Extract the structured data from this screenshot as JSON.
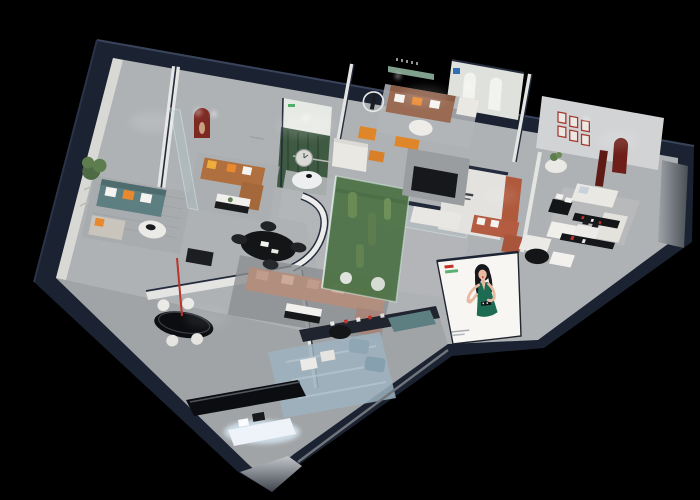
{
  "scene": {
    "kind": "3d-isometric-showroom-floorplan-render",
    "background": "#000000",
    "palette": {
      "outer_wall": "#1B2231",
      "outer_wall_edge": "#39445C",
      "floor": "#AFB2B5",
      "wall_white": "#E8E8E6",
      "mural_forest": "#3F5A42",
      "mural_sky": "#E7EAE4",
      "niche_red": "#7D2B22",
      "frame_red": "#A63A2E",
      "arch_dark_red": "#6E1F19",
      "column_dark_red": "#5E1B15",
      "terracotta_cabinet": "#B05A3D",
      "sofa_teal": "#5E7F82",
      "sofa_caramel": "#B06F3E",
      "sofa_brown": "#9A6A52",
      "sofa_white": "#EAE8E3",
      "sofa_mauve": "#B28E7F",
      "sofa_terracotta": "#B35C41",
      "pillow_orange": "#E8892F",
      "pillow_yellow": "#EFAE3B",
      "shelf_green": "#7FA08C",
      "sign_blue": "#2E6FB7",
      "logo_green": "#3FA65C",
      "logo_red": "#C23326",
      "garden_green": "#4F7348",
      "cactus_green": "#6B8B55",
      "orange_accent": "#E0862A",
      "rug_blue": "#9DB3C0",
      "rug_gray": "#A8ABAE",
      "table_black": "#141517",
      "gloss_black": "#0C0D10",
      "glow_bench": "#EDF3F8",
      "billboard_bg": "#F7F6F3",
      "dress_green": "#1E6B54",
      "hair_black": "#17181C",
      "skin": "#E9B9A2",
      "lips_red": "#C03A2E"
    },
    "rooms": [
      {
        "name": "lounge-teal-sofa",
        "items": [
          "teal-sofa",
          "round-coffee-table",
          "potted-plant",
          "chaise",
          "area-rug",
          "curved-relief-wall"
        ]
      },
      {
        "name": "living-caramel-sofa",
        "items": [
          "caramel-l-sofa",
          "red-arched-niche",
          "sculpture",
          "coffee-table",
          "glass-partition"
        ]
      },
      {
        "name": "forest-mural-room",
        "items": [
          "forest-mural-wall",
          "wall-clock",
          "green-logo-mark",
          "white-sofa",
          "round-table"
        ]
      },
      {
        "name": "living-brown-sofa",
        "items": [
          "brown-leather-sofa",
          "white-armchair",
          "ring-light-sculpture",
          "green-wall-shelf"
        ]
      },
      {
        "name": "arched-display-wall",
        "items": [
          "arch-niches",
          "blue-brand-sign"
        ]
      },
      {
        "name": "gallery-room",
        "items": [
          "red-frame-grid",
          "dark-red-arch",
          "round-side-table",
          "plant"
        ]
      },
      {
        "name": "living-white-sectional",
        "items": [
          "white-sectional",
          "black-dining-table",
          "media-shelf-red-accents",
          "dark-red-column"
        ]
      },
      {
        "name": "bedroom-right",
        "items": [
          "white-bed",
          "wardrobe-mirror-band"
        ]
      },
      {
        "name": "terracotta-lounge",
        "items": [
          "terracotta-sofa",
          "brand-partition-wall",
          "terracotta-cabinet"
        ]
      },
      {
        "name": "central-lounge",
        "items": [
          "curved-partition",
          "black-oval-dining-table",
          "mauve-sectional",
          "bw-coffee-table",
          "dark-rug"
        ]
      },
      {
        "name": "cactus-glass-garden",
        "items": [
          "glass-enclosure",
          "cacti",
          "pebble-plants"
        ]
      },
      {
        "name": "media-wall-area",
        "items": [
          "tv-panel",
          "orange-bench",
          "white-console"
        ]
      },
      {
        "name": "bar-area",
        "items": [
          "black-oval-bar-table",
          "bar-stools",
          "red-pendant-lamp"
        ]
      },
      {
        "name": "bottom-display-area",
        "items": [
          "glossy-console",
          "glowing-display-bench",
          "blue-poufs",
          "blue-rug",
          "black-shelf-red-accents",
          "white-ottomans"
        ]
      },
      {
        "name": "billboard",
        "items": [
          "woman-in-green-dress-advertisement",
          "brand-logo-marks",
          "caption-lines"
        ]
      }
    ]
  }
}
